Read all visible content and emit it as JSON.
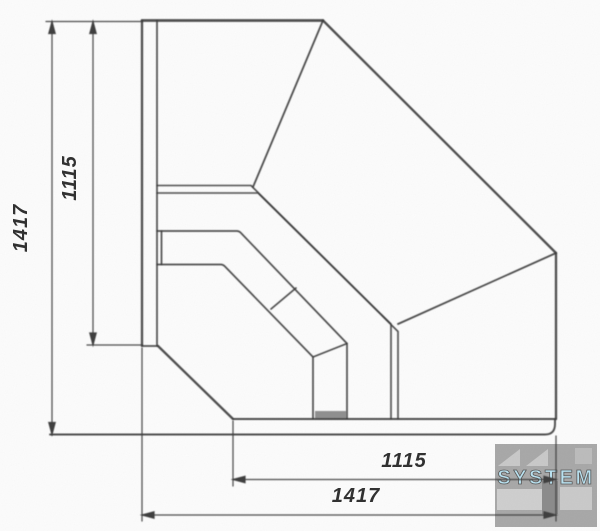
{
  "drawing": {
    "dimension_labels": {
      "left_outer": "1417",
      "left_inner": "1115",
      "bottom_inner": "1115",
      "bottom_outer": "1417"
    },
    "watermark": {
      "text": "SYSTEM"
    },
    "colors": {
      "line": "#3c3c3c",
      "label_text": "#2e2e2e",
      "watermark_box": "#a2a2a2",
      "watermark_text": "#b5e2f2",
      "watermark_bar": "#838383",
      "deck_fill": "#8f8f8f"
    }
  }
}
